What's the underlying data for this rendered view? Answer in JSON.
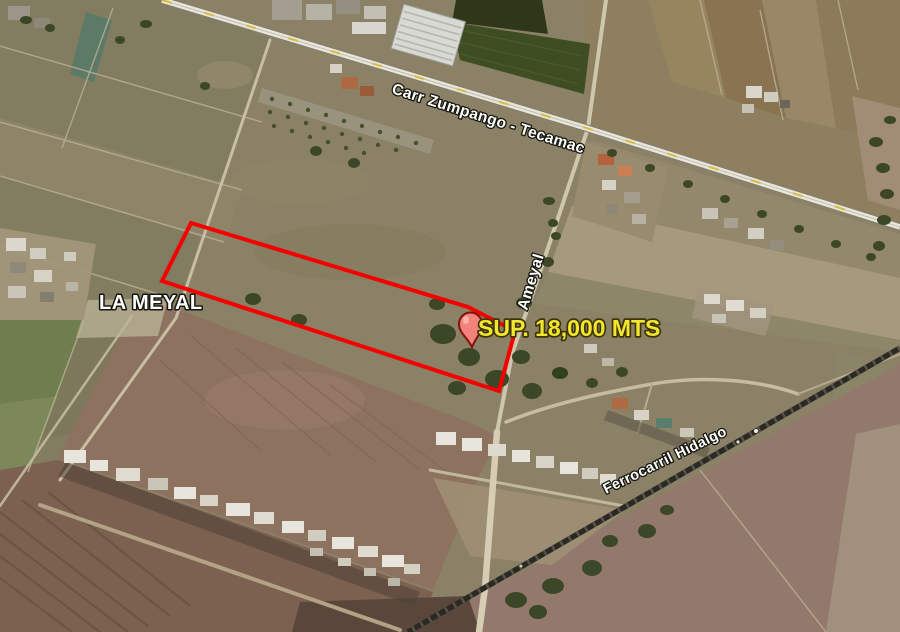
{
  "map": {
    "type": "satellite-aerial-view",
    "labels": {
      "highway": "Carr Zumpango - Tecamac",
      "place": "LA MEYAL",
      "street": "Ameyal",
      "railroad": "Ferrocarril Hidalgo",
      "area": "SUP. 18,000 MTS"
    },
    "parcel": {
      "name": "LA MEYAL",
      "surface_label": "SUP. 18,000 MTS",
      "surface_value": "18,000",
      "surface_unit": "MTS",
      "outline_points": "191,223 468,307 515,331 499,391 162,281",
      "outline_color": "#f40000"
    },
    "pin": {
      "fill": "#f2837a",
      "stroke": "#7e150c"
    },
    "label_colors": {
      "road_text": "#ffffff",
      "area_text": "#f2e72e"
    }
  }
}
